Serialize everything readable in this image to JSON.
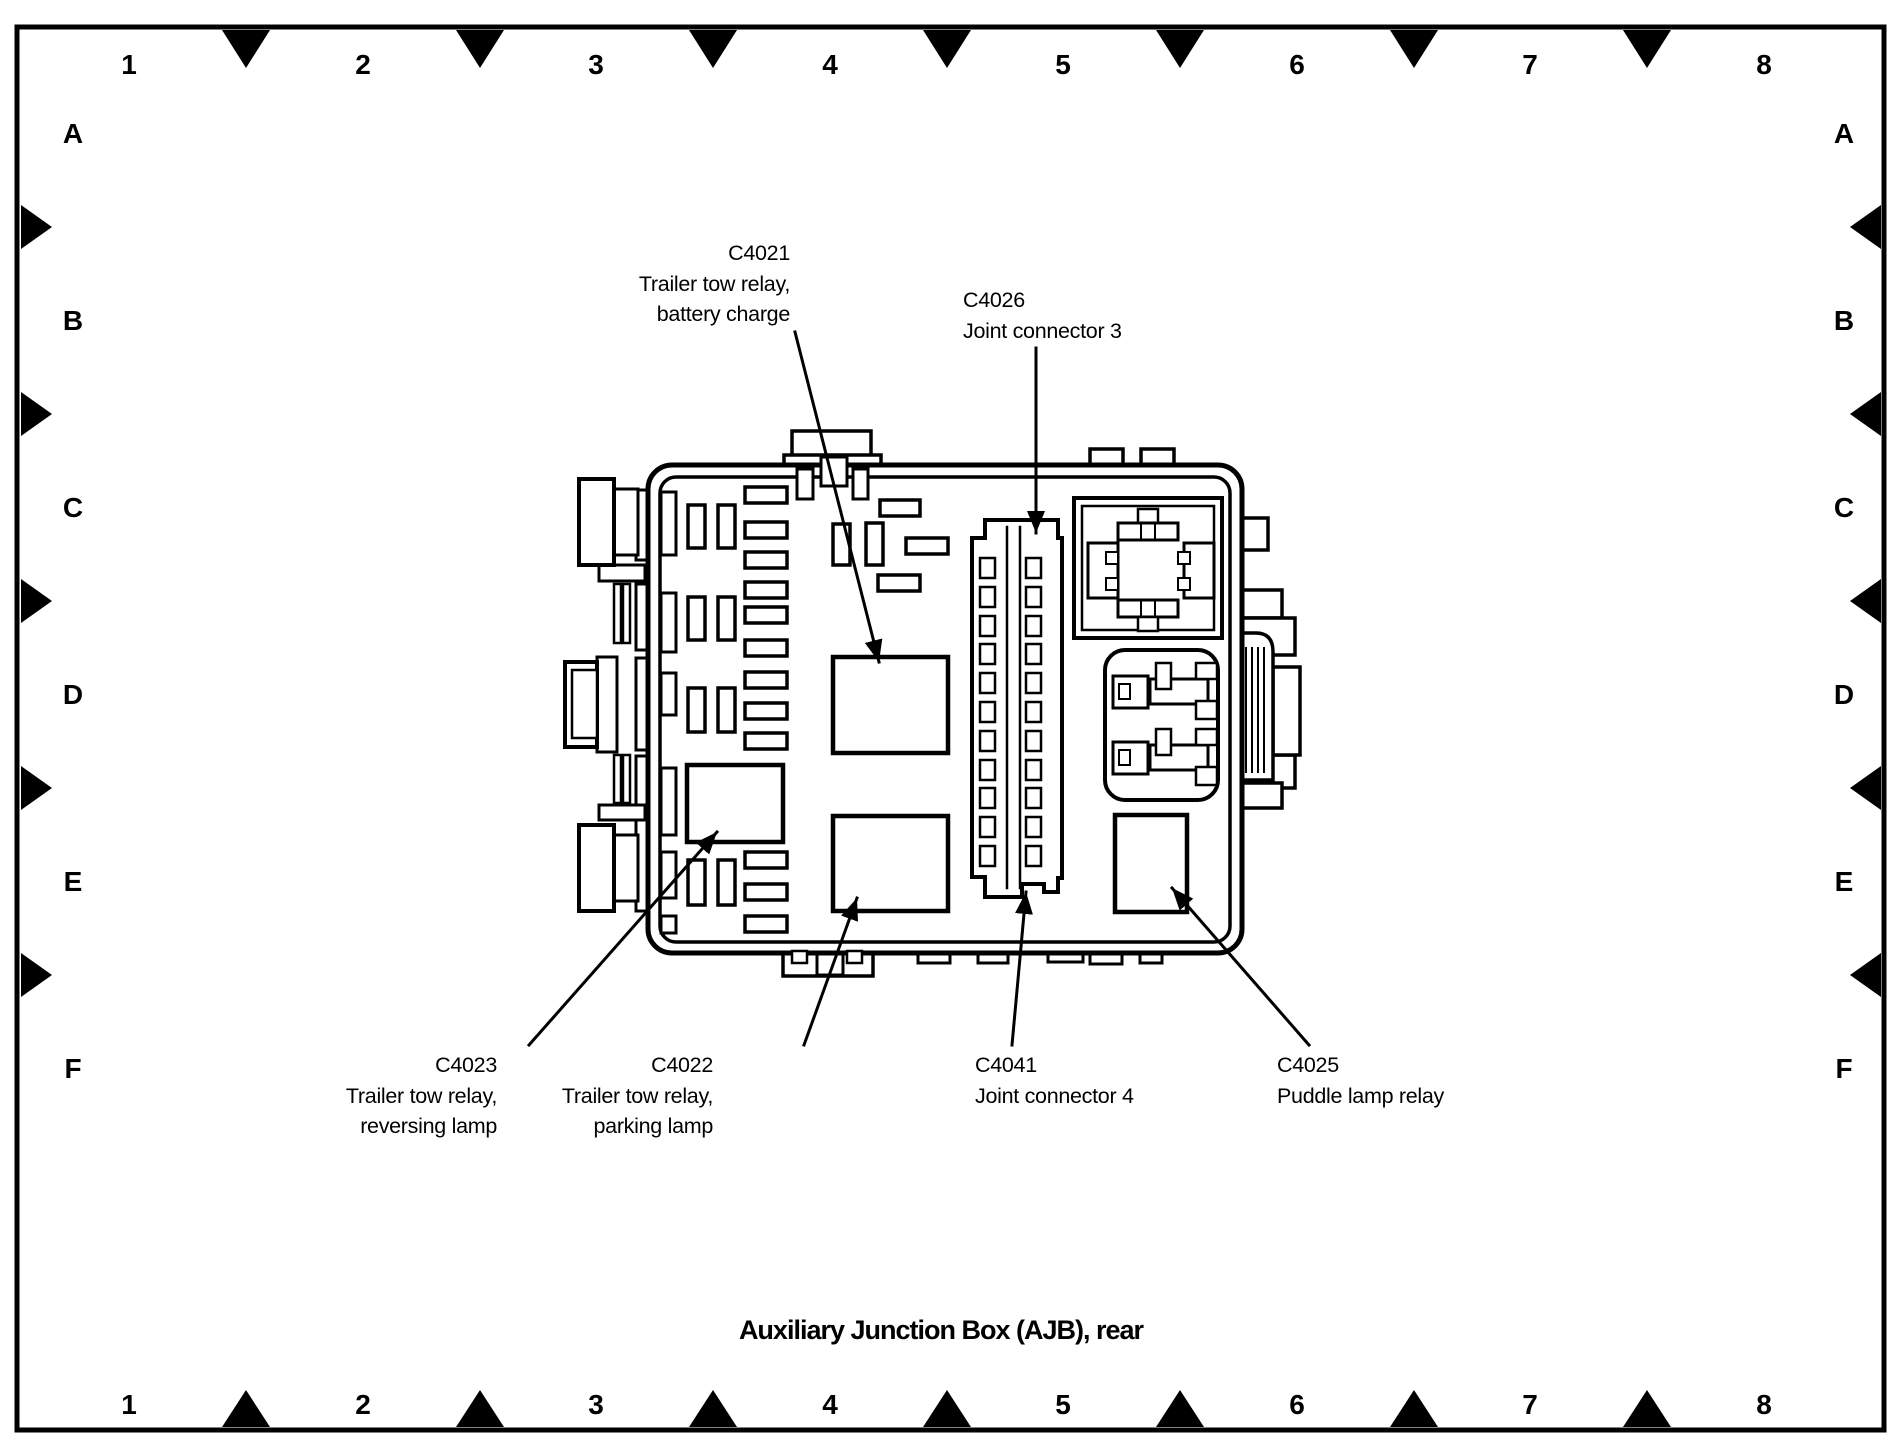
{
  "title": "Auxiliary Junction Box (AJB), rear",
  "grid": {
    "columns": [
      "1",
      "2",
      "3",
      "4",
      "5",
      "6",
      "7",
      "8"
    ],
    "rows": [
      "A",
      "B",
      "C",
      "D",
      "E",
      "F"
    ]
  },
  "callouts": {
    "c4021": {
      "lines": [
        "C4021",
        "Trailer tow relay,",
        "battery charge"
      ]
    },
    "c4026": {
      "lines": [
        "C4026",
        "Joint connector 3"
      ]
    },
    "c4023": {
      "lines": [
        "C4023",
        "Trailer tow relay,",
        "reversing lamp"
      ]
    },
    "c4022": {
      "lines": [
        "C4022",
        "Trailer tow relay,",
        "parking lamp"
      ]
    },
    "c4041": {
      "lines": [
        "C4041",
        "Joint connector 4"
      ]
    },
    "c4025": {
      "lines": [
        "C4025",
        "Puddle lamp relay"
      ]
    }
  },
  "colors": {
    "ink": "#000000",
    "paper": "#ffffff"
  }
}
